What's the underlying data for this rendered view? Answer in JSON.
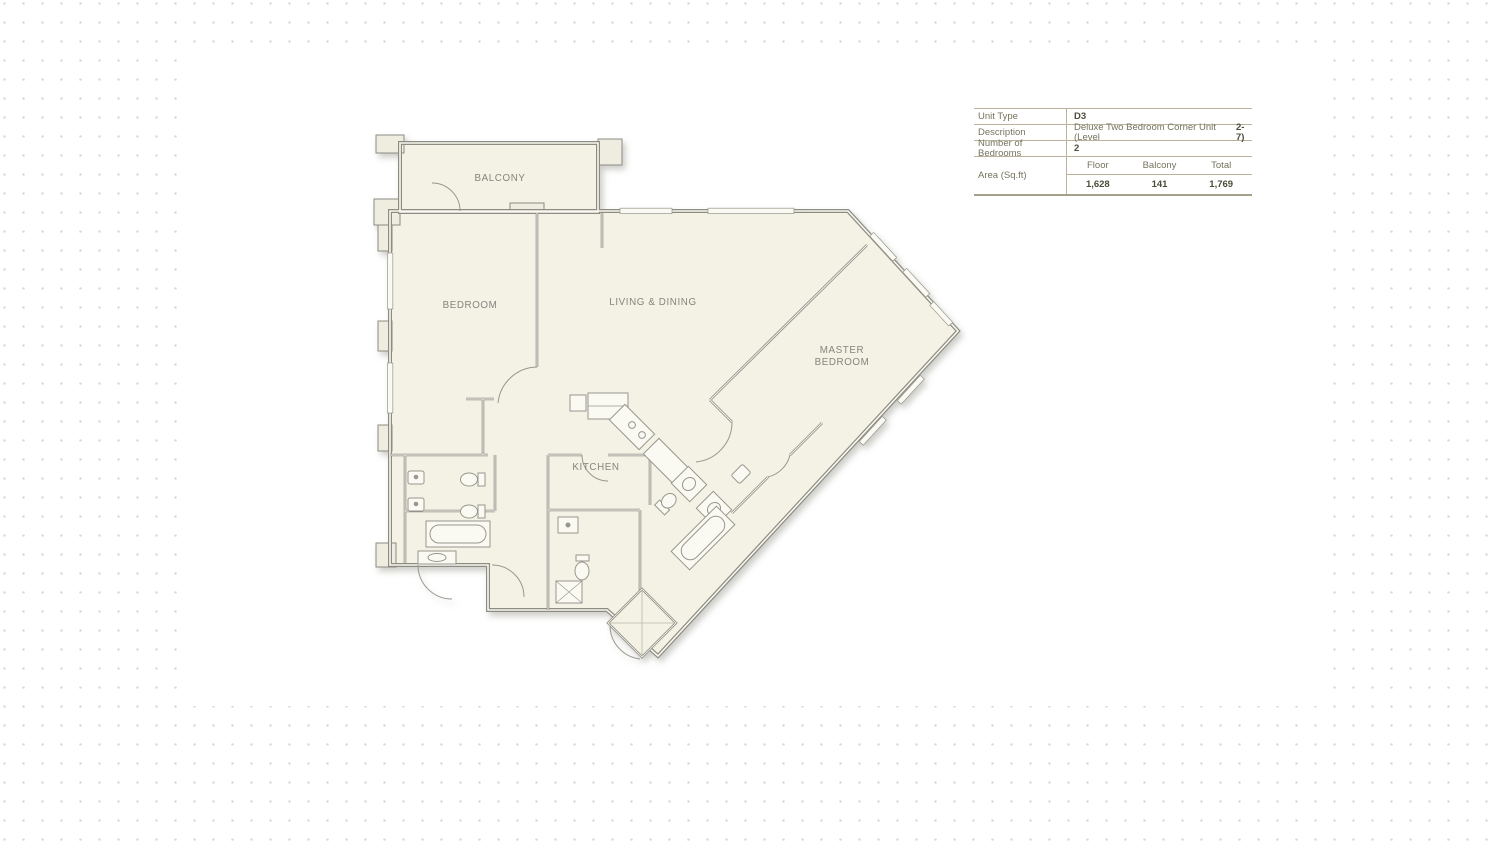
{
  "colors": {
    "dot": "#d4d4d4",
    "card": "#ffffff",
    "plan_fill": "#f4f2e4",
    "wall": "#8c8c85",
    "room_label": "#85857e",
    "table_border": "#b8b39a",
    "table_text": "#75735c",
    "table_strong_text": "#4d4b39"
  },
  "floorplan": {
    "rooms": {
      "balcony": "BALCONY",
      "bedroom": "BEDROOM",
      "living": "LIVING & DINING",
      "master_line1": "MASTER",
      "master_line2": "BEDROOM",
      "kitchen": "KITCHEN"
    }
  },
  "info_table": {
    "rows": [
      {
        "label": "Unit Type",
        "value": "D3"
      },
      {
        "label": "Description",
        "value": "Deluxe Two Bedroom Corner Unit (Level ",
        "value_bold": "2-7)"
      },
      {
        "label": "Number of Bedrooms",
        "value": "2"
      }
    ],
    "area_row": {
      "label": "Area (Sq.ft)",
      "columns": [
        "Floor",
        "Balcony",
        "Total"
      ],
      "values": [
        "1,628",
        "141",
        "1,769"
      ]
    }
  }
}
